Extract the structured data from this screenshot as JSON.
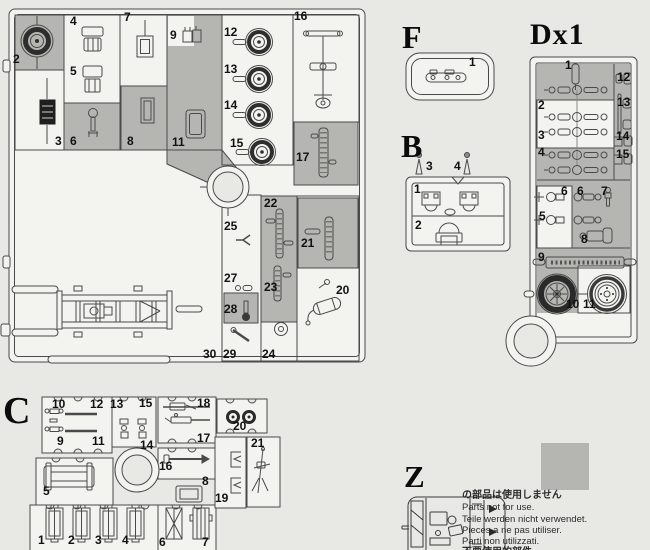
{
  "colors": {
    "page_bg": "#e8e8e4",
    "sprue_fill": "#f3f3ef",
    "unused_grey": "#b5b5b1",
    "line": "#4a4a4a"
  },
  "sprues": {
    "a": {
      "labels": [
        {
          "n": "2",
          "x": 13,
          "y": 54
        },
        {
          "n": "3",
          "x": 55,
          "y": 136
        },
        {
          "n": "4",
          "x": 70,
          "y": 16
        },
        {
          "n": "5",
          "x": 70,
          "y": 66
        },
        {
          "n": "6",
          "x": 70,
          "y": 136
        },
        {
          "n": "7",
          "x": 124,
          "y": 12
        },
        {
          "n": "8",
          "x": 127,
          "y": 136
        },
        {
          "n": "9",
          "x": 170,
          "y": 30
        },
        {
          "n": "11",
          "x": 172,
          "y": 137
        },
        {
          "n": "12",
          "x": 224,
          "y": 27
        },
        {
          "n": "13",
          "x": 224,
          "y": 64
        },
        {
          "n": "14",
          "x": 224,
          "y": 100
        },
        {
          "n": "15",
          "x": 230,
          "y": 138
        },
        {
          "n": "16",
          "x": 294,
          "y": 11
        },
        {
          "n": "17",
          "x": 296,
          "y": 152
        },
        {
          "n": "22",
          "x": 264,
          "y": 198
        },
        {
          "n": "21",
          "x": 301,
          "y": 238
        },
        {
          "n": "23",
          "x": 264,
          "y": 282
        },
        {
          "n": "25",
          "x": 224,
          "y": 221
        },
        {
          "n": "27",
          "x": 224,
          "y": 273
        },
        {
          "n": "28",
          "x": 224,
          "y": 304
        },
        {
          "n": "20",
          "x": 336,
          "y": 285
        },
        {
          "n": "30",
          "x": 203,
          "y": 349
        },
        {
          "n": "29",
          "x": 223,
          "y": 349
        },
        {
          "n": "24",
          "x": 262,
          "y": 349
        }
      ]
    },
    "f": {
      "letter": "F",
      "labels": [
        {
          "n": "1",
          "x": 469,
          "y": 57
        }
      ]
    },
    "b": {
      "letter": "B",
      "labels": [
        {
          "n": "3",
          "x": 426,
          "y": 161
        },
        {
          "n": "4",
          "x": 454,
          "y": 161
        },
        {
          "n": "1",
          "x": 414,
          "y": 184
        },
        {
          "n": "2",
          "x": 415,
          "y": 220
        }
      ]
    },
    "d": {
      "letter": "Dx1",
      "labels": [
        {
          "n": "1",
          "x": 565,
          "y": 60
        },
        {
          "n": "12",
          "x": 617,
          "y": 72
        },
        {
          "n": "2",
          "x": 538,
          "y": 100
        },
        {
          "n": "13",
          "x": 617,
          "y": 97
        },
        {
          "n": "3",
          "x": 538,
          "y": 130
        },
        {
          "n": "4",
          "x": 538,
          "y": 147
        },
        {
          "n": "14",
          "x": 616,
          "y": 131
        },
        {
          "n": "15",
          "x": 616,
          "y": 149
        },
        {
          "n": "6",
          "x": 561,
          "y": 186
        },
        {
          "n": "6",
          "x": 577,
          "y": 186
        },
        {
          "n": "7",
          "x": 601,
          "y": 186
        },
        {
          "n": "5",
          "x": 539,
          "y": 211
        },
        {
          "n": "8",
          "x": 581,
          "y": 234
        },
        {
          "n": "9",
          "x": 538,
          "y": 252
        },
        {
          "n": "10",
          "x": 566,
          "y": 299
        },
        {
          "n": "11",
          "x": 583,
          "y": 299
        }
      ]
    },
    "c": {
      "letter": "C",
      "labels": [
        {
          "n": "10",
          "x": 52,
          "y": 399
        },
        {
          "n": "12",
          "x": 90,
          "y": 399
        },
        {
          "n": "13",
          "x": 110,
          "y": 399
        },
        {
          "n": "15",
          "x": 139,
          "y": 398
        },
        {
          "n": "18",
          "x": 197,
          "y": 398
        },
        {
          "n": "9",
          "x": 57,
          "y": 436
        },
        {
          "n": "11",
          "x": 92,
          "y": 436
        },
        {
          "n": "14",
          "x": 140,
          "y": 440
        },
        {
          "n": "17",
          "x": 197,
          "y": 433
        },
        {
          "n": "16",
          "x": 159,
          "y": 461
        },
        {
          "n": "20",
          "x": 233,
          "y": 421
        },
        {
          "n": "21",
          "x": 251,
          "y": 438
        },
        {
          "n": "5",
          "x": 43,
          "y": 486
        },
        {
          "n": "8",
          "x": 202,
          "y": 476
        },
        {
          "n": "19",
          "x": 215,
          "y": 493
        },
        {
          "n": "1",
          "x": 38,
          "y": 535
        },
        {
          "n": "2",
          "x": 68,
          "y": 535
        },
        {
          "n": "3",
          "x": 95,
          "y": 535
        },
        {
          "n": "4",
          "x": 122,
          "y": 535
        },
        {
          "n": "6",
          "x": 159,
          "y": 537
        },
        {
          "n": "7",
          "x": 202,
          "y": 537
        }
      ]
    },
    "z": {
      "letter": "Z"
    }
  },
  "legend": {
    "swatch_color": "#b5b5b1",
    "lines": [
      "の部品は使用しません",
      "Parts not for use.",
      "Teile werden nicht verwendet.",
      "Pieces a ne pas utiliser.",
      "Parti non utilizzati.",
      "不要使用的部件"
    ]
  }
}
